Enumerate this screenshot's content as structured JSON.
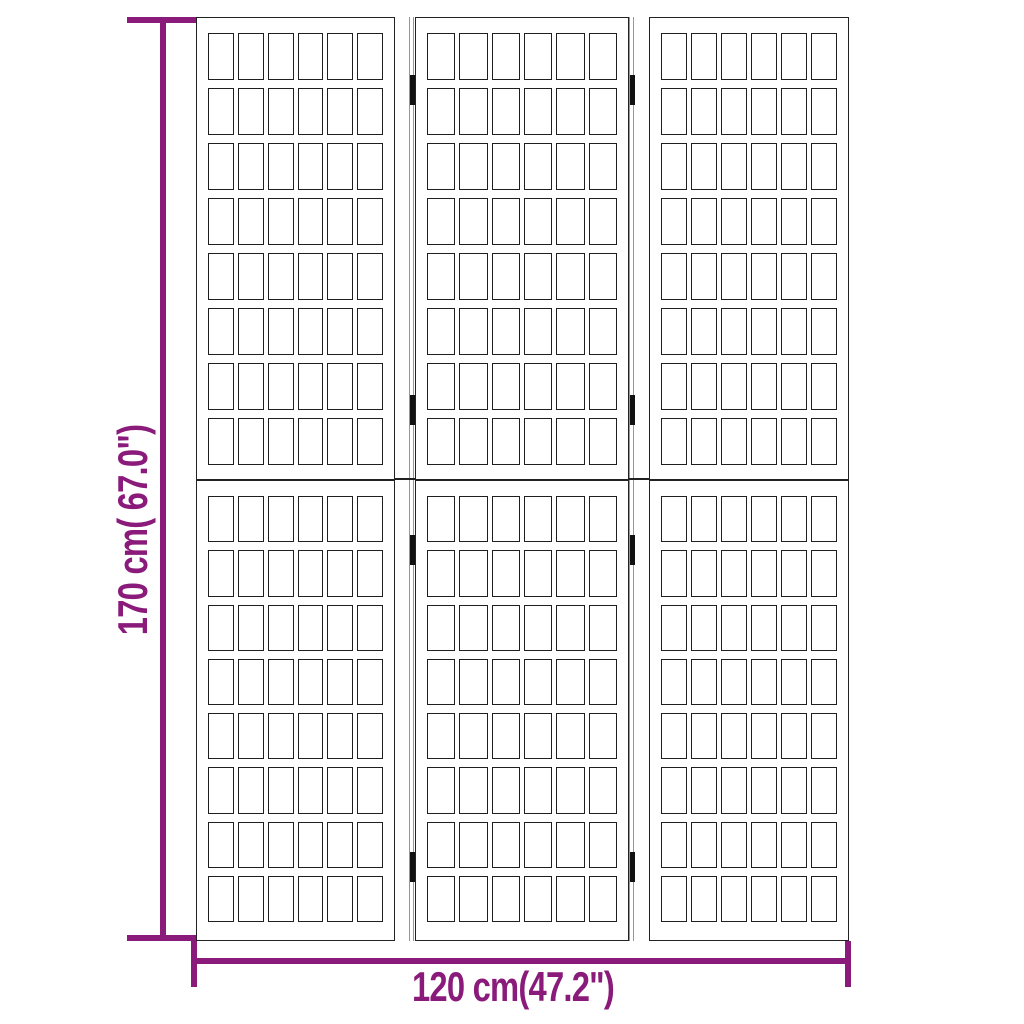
{
  "dimensions": {
    "height_label": "170 cm( 67.0\")",
    "width_label": "120 cm(47.2\")",
    "accent_color": "#8a1b7b"
  },
  "diagram": {
    "panel_count": 3,
    "sections_per_panel": 2,
    "lattice_columns": 6,
    "lattice_rows": 8,
    "folds": 2,
    "hinges_per_fold": 4,
    "frame_color": "#222222",
    "lattice_line_color": "#1f1f1f",
    "fold_line_color": "#979797",
    "hinge_color": "#111111",
    "background_color": "#ffffff"
  }
}
